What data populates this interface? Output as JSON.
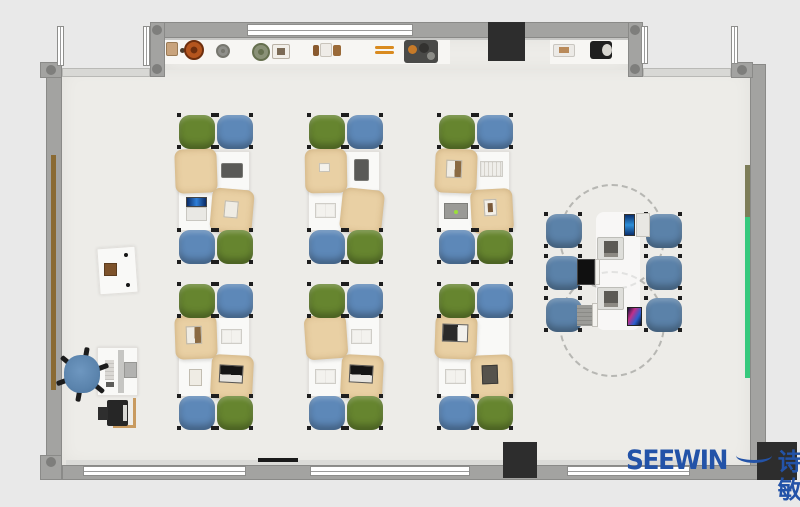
{
  "branding": {
    "logo_text": "SEEWIN",
    "logo_cn": "诗敏",
    "logo_color": "#2353a8"
  },
  "palette": {
    "outside": "#e9e9e9",
    "floor": "#edece8",
    "wall": "#a3a3a1",
    "window": "#ffffff",
    "shelf": "#f7f6f3",
    "pillar": "#2d2d2d",
    "chair_green": "#66852f",
    "chair_blue": "#5d88b8",
    "chair_blue_collab": "#5b82a9",
    "cloth": "#e9d0a4",
    "door_strip": "#8a6a33",
    "board_green": "#36c97d",
    "board_olive": "#7d7d58"
  },
  "scene": {
    "floors": [
      {
        "name": "room-floor",
        "x": 62,
        "y": 68,
        "w": 688,
        "h": 397
      },
      {
        "name": "alcove-floor",
        "x": 165,
        "y": 38,
        "w": 463,
        "h": 32
      }
    ],
    "shelves": [
      {
        "name": "display-shelf-left",
        "x": 165,
        "y": 38,
        "w": 285,
        "h": 26
      },
      {
        "name": "display-shelf-right",
        "x": 550,
        "y": 38,
        "w": 78,
        "h": 26
      }
    ],
    "glass_bands": [
      {
        "name": "glass-wall-left",
        "x": 62,
        "y": 68,
        "w": 88,
        "h": 9
      },
      {
        "name": "glass-wall-right",
        "x": 643,
        "y": 68,
        "w": 88,
        "h": 9
      }
    ],
    "walls": [
      {
        "name": "wall-top",
        "x": 150,
        "y": 22,
        "w": 493,
        "h": 16
      },
      {
        "name": "wall-top-left-column",
        "x": 150,
        "y": 22,
        "w": 15,
        "h": 55
      },
      {
        "name": "wall-top-right-column",
        "x": 628,
        "y": 22,
        "w": 15,
        "h": 55
      },
      {
        "name": "wall-left",
        "x": 46,
        "y": 64,
        "w": 16,
        "h": 398
      },
      {
        "name": "wall-right",
        "x": 750,
        "y": 64,
        "w": 16,
        "h": 416
      },
      {
        "name": "wall-bottom",
        "x": 62,
        "y": 465,
        "w": 704,
        "h": 15
      },
      {
        "name": "wall-corner-top-left",
        "x": 40,
        "y": 62,
        "w": 22,
        "h": 16
      },
      {
        "name": "wall-corner-bottom-left",
        "x": 40,
        "y": 455,
        "w": 22,
        "h": 25
      },
      {
        "name": "wall-corner-top-right",
        "x": 731,
        "y": 62,
        "w": 22,
        "h": 16
      }
    ],
    "joints": [
      [
        157,
        30
      ],
      [
        157,
        69
      ],
      [
        635,
        30
      ],
      [
        635,
        69
      ],
      [
        51,
        70
      ],
      [
        742,
        70
      ],
      [
        51,
        462
      ]
    ],
    "windows_v": [
      {
        "name": "window-upper-far-left",
        "x": 57,
        "y": 26,
        "w": 7,
        "h": 40
      },
      {
        "name": "window-upper-left",
        "x": 143,
        "y": 26,
        "w": 7,
        "h": 40
      },
      {
        "name": "window-upper-right",
        "x": 641,
        "y": 26,
        "w": 7,
        "h": 38
      },
      {
        "name": "window-upper-far-right",
        "x": 731,
        "y": 26,
        "w": 7,
        "h": 38
      }
    ],
    "windows_h": [
      {
        "name": "window-top-center",
        "x": 247,
        "y": 24,
        "w": 166,
        "h": 12
      },
      {
        "name": "window-bottom-1",
        "x": 83,
        "y": 466,
        "w": 163,
        "h": 10
      },
      {
        "name": "window-bottom-2",
        "x": 310,
        "y": 466,
        "w": 160,
        "h": 10
      },
      {
        "name": "window-bottom-3",
        "x": 567,
        "y": 466,
        "w": 123,
        "h": 10
      }
    ],
    "sill": {
      "name": "window-sill",
      "x": 66,
      "y": 460,
      "w": 640,
      "h": 6
    },
    "radiator": {
      "name": "radiator",
      "x": 258,
      "y": 458,
      "w": 40,
      "h": 4,
      "c": "#1a1a1a"
    },
    "pillars": [
      {
        "name": "column-top",
        "x": 488,
        "y": 22,
        "w": 37,
        "h": 39
      },
      {
        "name": "column-bottom-center",
        "x": 503,
        "y": 442,
        "w": 34,
        "h": 36
      },
      {
        "name": "column-bottom-right",
        "x": 757,
        "y": 442,
        "w": 40,
        "h": 38
      }
    ],
    "strips": [
      {
        "name": "door-panel-left-wall",
        "x": 51,
        "y": 155,
        "w": 5,
        "h": 235,
        "c": "#8a6a33"
      },
      {
        "name": "board-olive-right-wall",
        "x": 745,
        "y": 165,
        "w": 5,
        "h": 52,
        "c": "#7d7d58"
      },
      {
        "name": "board-green-right-wall",
        "x": 745,
        "y": 217,
        "w": 5,
        "h": 161,
        "c": "#36c97d"
      }
    ],
    "shelf_items": [
      {
        "name": "decor-box-tan",
        "kind": "rect",
        "x": 166,
        "y": 42,
        "w": 12,
        "h": 14,
        "c": "#c8a37c",
        "b": "#9a7a54"
      },
      {
        "name": "decor-knob",
        "kind": "disc",
        "x": 180,
        "y": 48,
        "w": 5,
        "h": 5,
        "c": "#4a3c2c"
      },
      {
        "name": "decor-plate-orange",
        "kind": "ringdisc",
        "x": 184,
        "y": 40,
        "w": 20,
        "h": 20,
        "c": "#b4551e",
        "ring": "#6e2f0e"
      },
      {
        "name": "decor-plate-gray",
        "kind": "ringdisc",
        "x": 216,
        "y": 44,
        "w": 14,
        "h": 14,
        "c": "#8f8f8a",
        "ring": "#77776f"
      },
      {
        "name": "decor-plant",
        "kind": "ringdisc",
        "x": 252,
        "y": 43,
        "w": 18,
        "h": 18,
        "c": "#8a9177",
        "ring": "#66704f"
      },
      {
        "name": "decor-frame",
        "kind": "rect",
        "x": 272,
        "y": 44,
        "w": 18,
        "h": 15,
        "c": "#f2efe9",
        "b": "#b9b2a6",
        "inner": "#7b6a55"
      },
      {
        "name": "decor-book-brown",
        "kind": "rect",
        "x": 313,
        "y": 45,
        "w": 6,
        "h": 11,
        "c": "#8a5a2e"
      },
      {
        "name": "decor-box-white",
        "kind": "rect",
        "x": 320,
        "y": 43,
        "w": 12,
        "h": 14,
        "c": "#efece7",
        "b": "#c9c4bb"
      },
      {
        "name": "decor-book-brown-2",
        "kind": "rect",
        "x": 333,
        "y": 45,
        "w": 8,
        "h": 11,
        "c": "#9a6a38"
      },
      {
        "name": "decor-sticks",
        "kind": "sticks",
        "x": 375,
        "y": 46,
        "w": 19,
        "h": 8,
        "c": "#d98a1e"
      },
      {
        "name": "decor-tray",
        "kind": "tray",
        "x": 404,
        "y": 40,
        "w": 34,
        "h": 23
      },
      {
        "name": "decor-box-white-2",
        "kind": "rect",
        "x": 553,
        "y": 44,
        "w": 22,
        "h": 13,
        "c": "#eceae6",
        "b": "#c9c6c0",
        "inner": "#b98a5a"
      },
      {
        "name": "decor-speaker",
        "kind": "speaker",
        "x": 590,
        "y": 41,
        "w": 22,
        "h": 18
      }
    ],
    "cluster_columns": [
      178,
      308,
      438
    ],
    "cluster_rows": [
      {
        "chair_top_y": 115,
        "desk_y": 151,
        "chair_bottom_y": 230
      },
      {
        "chair_top_y": 284,
        "desk_y": 317,
        "chair_bottom_y": 396
      }
    ],
    "desk": {
      "w": 36,
      "h": 40
    },
    "chair": {
      "w": 36,
      "h": 34
    },
    "chair_layout": {
      "top": [
        "green",
        "blue"
      ],
      "bottom": [
        "blue",
        "green"
      ]
    },
    "cluster_items": [
      [
        {
          "t": "cloth",
          "rot": -2
        },
        {
          "t": "tablet-l"
        },
        {
          "t": "laptop-open"
        },
        {
          "t": "cloth",
          "rot": 5,
          "sub": "note"
        }
      ],
      [
        {
          "t": "cloth",
          "rot": -1,
          "sub": "card"
        },
        {
          "t": "tablet-p"
        },
        {
          "t": "book"
        },
        {
          "t": "cloth",
          "rot": 6
        }
      ],
      [
        {
          "t": "cloth",
          "rot": 2,
          "sub": "book"
        },
        {
          "t": "notebook"
        },
        {
          "t": "laptop-flat"
        },
        {
          "t": "cloth",
          "rot": -3,
          "sub": "pic"
        }
      ],
      [
        {
          "t": "cloth",
          "rot": -2,
          "sub": "book"
        },
        {
          "t": "book"
        },
        {
          "t": "booklet"
        },
        {
          "t": "cloth",
          "rot": 3,
          "sub": "laptop"
        }
      ],
      [
        {
          "t": "cloth",
          "rot": -4
        },
        {
          "t": "book"
        },
        {
          "t": "book"
        },
        {
          "t": "cloth",
          "rot": 3,
          "sub": "laptop"
        }
      ],
      [
        {
          "t": "cloth",
          "rot": 2,
          "sub": "laptop2"
        },
        {
          "t": "none"
        },
        {
          "t": "book"
        },
        {
          "t": "cloth",
          "rot": -2,
          "sub": "darkbook"
        }
      ]
    ],
    "collab": {
      "circles": [
        {
          "cx": 612,
          "cy": 237,
          "r": 53
        },
        {
          "cx": 612,
          "cy": 324,
          "r": 53
        }
      ],
      "surface": {
        "x": 596,
        "y": 212,
        "w": 44,
        "h": 118
      },
      "chairs": [
        {
          "x": 546,
          "y": 214
        },
        {
          "x": 546,
          "y": 256
        },
        {
          "x": 546,
          "y": 298
        },
        {
          "x": 646,
          "y": 214
        },
        {
          "x": 646,
          "y": 256
        },
        {
          "x": 646,
          "y": 298
        }
      ],
      "devices": [
        {
          "name": "tablet-display",
          "kind": "combo-tablet",
          "x": 624,
          "y": 214
        },
        {
          "name": "mini-cabinet",
          "kind": "cabinet",
          "x": 597,
          "y": 237
        },
        {
          "name": "laptop",
          "kind": "laptop-dark",
          "x": 577,
          "y": 259
        },
        {
          "name": "mini-cabinet",
          "kind": "cabinet",
          "x": 597,
          "y": 287
        },
        {
          "name": "laptop",
          "kind": "laptop-gray",
          "x": 577,
          "y": 305
        },
        {
          "name": "smartphone",
          "kind": "phone",
          "x": 627,
          "y": 307
        }
      ]
    },
    "teacher": {
      "desk_upper": {
        "x": 98,
        "y": 247,
        "w": 39,
        "h": 47,
        "rot": -4
      },
      "upper_box": {
        "x": 104,
        "y": 263,
        "w": 13,
        "h": 13,
        "c": "#7d522a"
      },
      "upper_dots": [
        [
          124,
          253
        ],
        [
          126,
          283
        ]
      ],
      "desk_main": {
        "x": 97,
        "y": 347,
        "w": 41,
        "h": 49
      },
      "divider": {
        "x": 118,
        "y": 350,
        "w": 6,
        "h": 43
      },
      "monitor": {
        "x": 124,
        "y": 362,
        "w": 13,
        "h": 16
      },
      "keyboard": {
        "x": 105,
        "y": 360,
        "w": 9,
        "h": 20
      },
      "small_item": {
        "x": 106,
        "y": 382,
        "w": 8,
        "h": 5
      },
      "chair_seat": {
        "x": 64,
        "y": 355,
        "w": 36,
        "h": 38
      },
      "chair_center": [
        82,
        374
      ],
      "printer": {
        "x": 107,
        "y": 400,
        "w": 21,
        "h": 26
      },
      "printer_tab": {
        "x": 98,
        "y": 407,
        "w": 10,
        "h": 13
      },
      "printer_label": {
        "x": 123,
        "y": 405,
        "w": 4,
        "h": 16
      },
      "frame_v": {
        "x": 133,
        "y": 398,
        "w": 3,
        "h": 30
      },
      "frame_h": {
        "x": 113,
        "y": 425,
        "w": 23,
        "h": 3
      }
    }
  }
}
